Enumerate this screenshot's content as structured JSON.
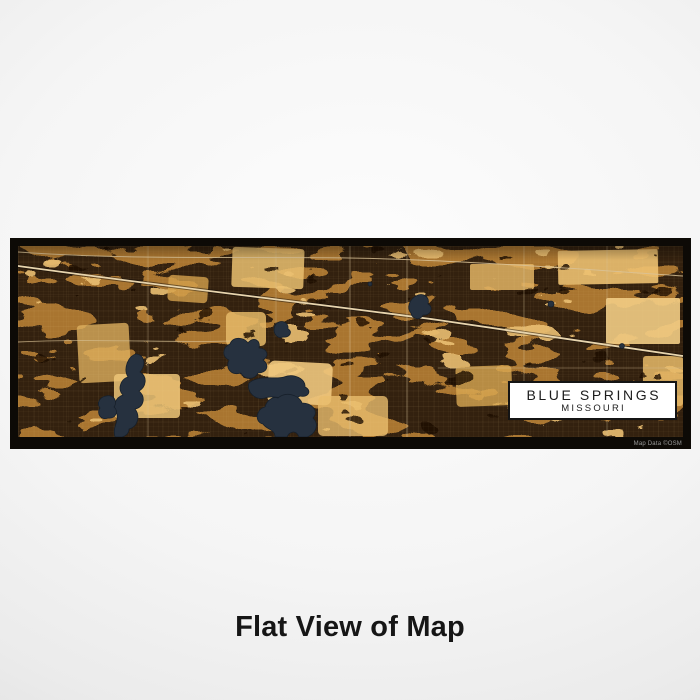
{
  "map": {
    "title_box": {
      "city": "BLUE SPRINGS",
      "state": "MISSOURI"
    },
    "attribution": "Map Data ©OSM",
    "palette": {
      "frame_black": "#0d0a06",
      "base_brown": "#33210f",
      "mid_amber": "#b07a31",
      "light_amber": "#eabf72",
      "water_navy": "#26313f",
      "road_cream": "#e8d5ae",
      "title_text": "#1c1c1c",
      "title_box_bg": "#ffffff",
      "background_gray": "#ebebeb"
    }
  },
  "caption": {
    "text": "Flat View of Map"
  }
}
